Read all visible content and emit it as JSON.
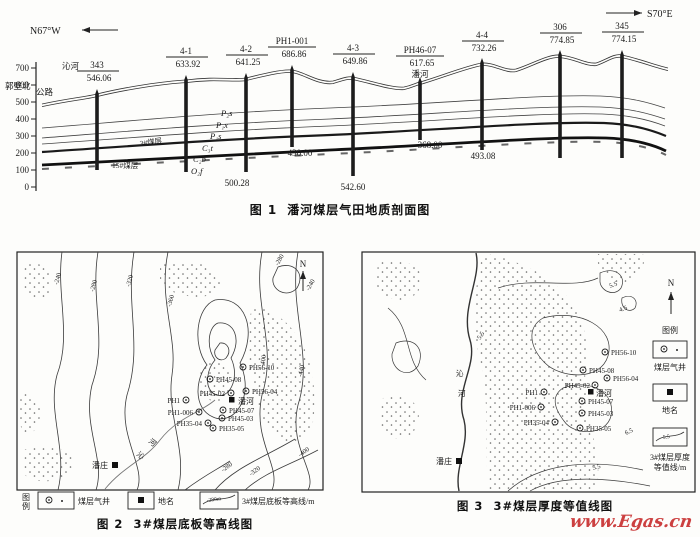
{
  "page": {
    "watermark": "www.Egas.cn"
  },
  "fig1": {
    "caption_label": "图 1",
    "caption_text": "潘河煤层气田地质剖面图",
    "dir_left": "N67°W",
    "dir_right": "S70°E",
    "axis_ticks": [
      "700",
      "600",
      "500",
      "400",
      "300",
      "200",
      "100",
      "0"
    ],
    "wells": [
      {
        "name": "343",
        "elev": "546.06"
      },
      {
        "name": "4-1",
        "elev": "633.92"
      },
      {
        "name": "4-2",
        "elev": "641.25"
      },
      {
        "name": "PH1-001",
        "elev": "686.86"
      },
      {
        "name": "4-3",
        "elev": "649.86"
      },
      {
        "name": "PH46-07",
        "elev": "617.65"
      },
      {
        "name": "4-4",
        "elev": "732.26"
      },
      {
        "name": "306",
        "elev": "774.85"
      },
      {
        "name": "345",
        "elev": "774.15"
      }
    ],
    "depths": [
      "500.28",
      "430.00",
      "542.60",
      "368.00",
      "493.08"
    ],
    "strata": [
      "P₂s",
      "P₁x",
      "P₁s",
      "C₃t",
      "C₂b",
      "O₂f"
    ],
    "coal_seam_3": "3#煤层",
    "coal_seam_15": "15#煤层",
    "place_qinhe": "沁河",
    "place_guobibei": "郭壁北",
    "place_highway": "公路",
    "place_panhe": "潘河"
  },
  "fig2": {
    "caption_label": "图 2",
    "caption_text": "3#煤层底板等高线图",
    "north": "N",
    "legend_title_1": "图",
    "legend_title_2": "例",
    "legend": {
      "well": "煤层气井",
      "place": "地名",
      "contour": "3#煤层底板等高线/m",
      "contour_sample": "-280m"
    },
    "towns": {
      "panhe": "潘河",
      "panzhuang": "潘庄"
    },
    "river_1": "沁",
    "river_2": "河",
    "wells": [
      "PH56-10",
      "PH45-08",
      "PH45-02",
      "PH56-04",
      "PH1",
      "PH1-006",
      "PH45-07",
      "PH45-03",
      "PH35-04",
      "PH35-05"
    ],
    "contour_labels": [
      "-240",
      "-280",
      "-320",
      "-360",
      "-400",
      "-440",
      "-280",
      "-240",
      "-280",
      "-320",
      "-400"
    ]
  },
  "fig3": {
    "caption_label": "图 3",
    "caption_text": "3#煤层厚度等值线图",
    "north": "N",
    "legend_title": "图例",
    "legend": {
      "well": "煤层气井",
      "place": "地名",
      "contour_1": "3#煤层厚度",
      "contour_2": "等值线/m",
      "contour_sample": "5.5"
    },
    "towns": {
      "panhe": "潘河",
      "panzhuang": "潘庄"
    },
    "river_1": "沁",
    "river_2": "河",
    "wells": [
      "PH56-10",
      "PH45-08",
      "PH45-02",
      "PH56-04",
      "PH1",
      "PH1-006",
      "PH45-07",
      "PH45-03",
      "PH35-04",
      "PH35-05"
    ],
    "contour_labels": [
      "5.5",
      "4.5",
      "6.5",
      "5.5",
      "5.5"
    ]
  }
}
